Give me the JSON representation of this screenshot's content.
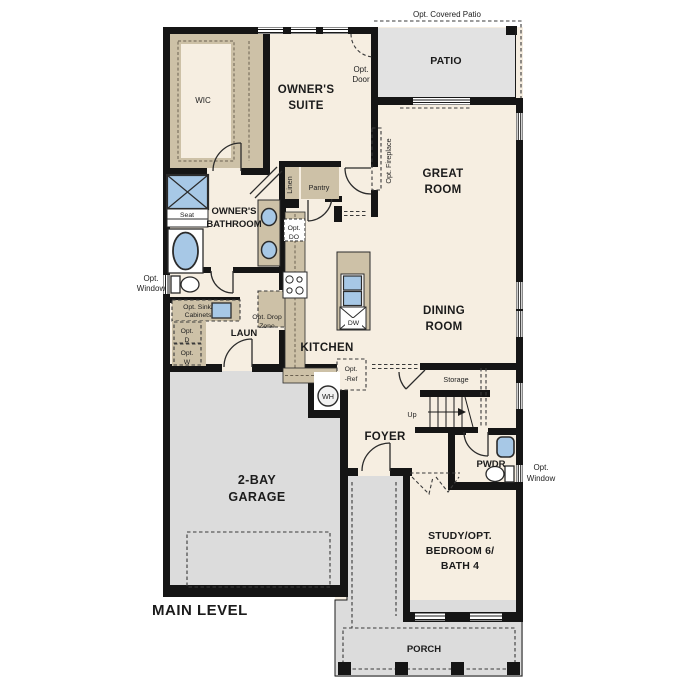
{
  "plan": {
    "title": "MAIN LEVEL",
    "rooms": {
      "wic": "WIC",
      "owners_suite": [
        "OWNER'S",
        "SUITE"
      ],
      "patio": "PATIO",
      "great_room": [
        "GREAT",
        "ROOM"
      ],
      "owners_bathroom": [
        "OWNER'S",
        "BATHROOM"
      ],
      "dining_room": [
        "DINING",
        "ROOM"
      ],
      "kitchen": "KITCHEN",
      "laundry": "LAUN",
      "garage": [
        "2-BAY",
        "GARAGE"
      ],
      "foyer": "FOYER",
      "powder": "PWDR",
      "study": [
        "STUDY/OPT.",
        "BEDROOM 6/",
        "BATH 4"
      ],
      "porch": "PORCH",
      "storage": "Storage"
    },
    "features": {
      "opt_covered_patio": "Opt. Covered Patio",
      "opt_door": [
        "Opt.",
        "Door"
      ],
      "opt_fireplace": "Opt. Fireplace",
      "opt_window": [
        "Opt.",
        "Window"
      ],
      "linen": "Linen",
      "pantry": "Pantry",
      "seat": "Seat",
      "up": "Up",
      "opt_do": [
        "Opt.",
        "DO"
      ],
      "opt_sink_cabinets": [
        "Opt. Sink/",
        "Cabinets"
      ],
      "opt_dryer": [
        "Opt.",
        "D"
      ],
      "opt_washer": [
        "Opt.",
        "W"
      ],
      "opt_drop_zone": [
        "Opt. Drop",
        "Zone"
      ],
      "opt_ref": [
        "Opt.",
        "-Ref"
      ],
      "dishwasher": "DW",
      "water_heater": "WH"
    },
    "colors": {
      "wall": "#151515",
      "floor": "#f6eee1",
      "hard": "#dcdcdc",
      "patio": "#e2e2e2",
      "cabinet": "#cdc1a7",
      "fixture": "#a7c8e6"
    }
  }
}
